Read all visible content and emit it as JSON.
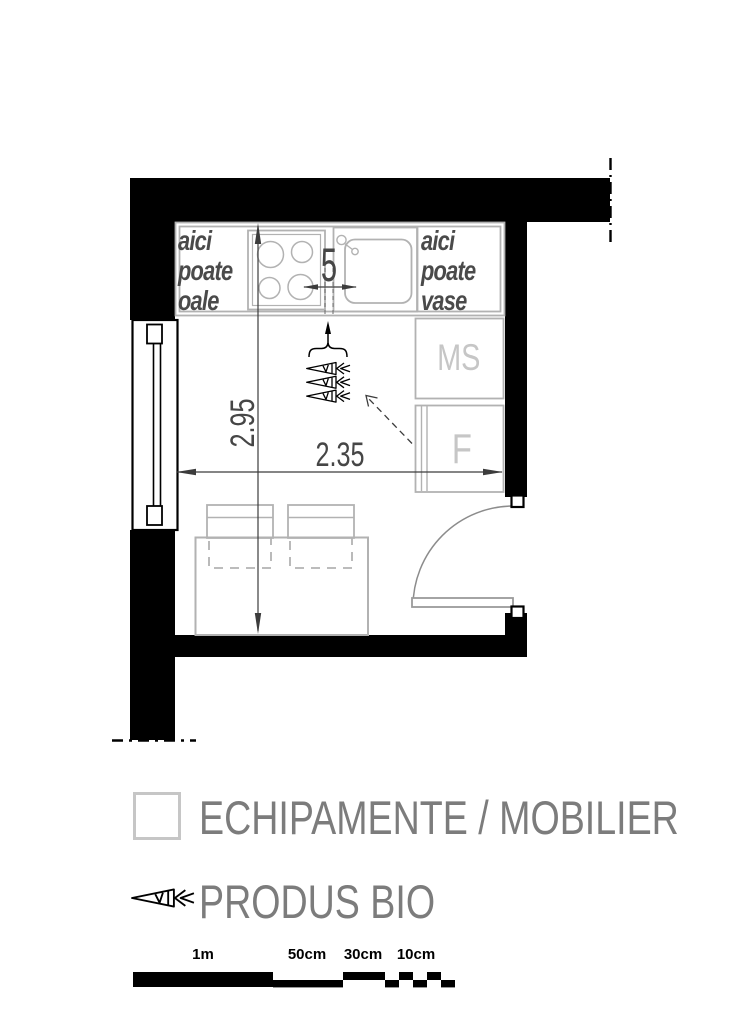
{
  "plan": {
    "pots_label_lines": [
      "aici",
      "poate",
      "oale"
    ],
    "dishes_label_lines": [
      "aici",
      "poate",
      "vase"
    ],
    "gap_dimension": "5",
    "room_height_dimension": "2.95",
    "room_width_dimension": "2.35",
    "washing_machine_label": "MS",
    "fridge_label": "F"
  },
  "legend": {
    "equipment_label": "ECHIPAMENTE / MOBILIER",
    "bio_label": "PRODUS BIO"
  },
  "scale_bar": {
    "labels": [
      "1m",
      "50cm",
      "30cm",
      "10cm"
    ]
  },
  "colors": {
    "wall_black": "#000000",
    "furniture_gray": "#b2b2b2",
    "label_text_gray": "#4a4a4a",
    "appliance_letter_gray": "#c6c6c6",
    "legend_text_gray": "#7c7c7c",
    "dimension_gray": "#3c3c3c"
  }
}
